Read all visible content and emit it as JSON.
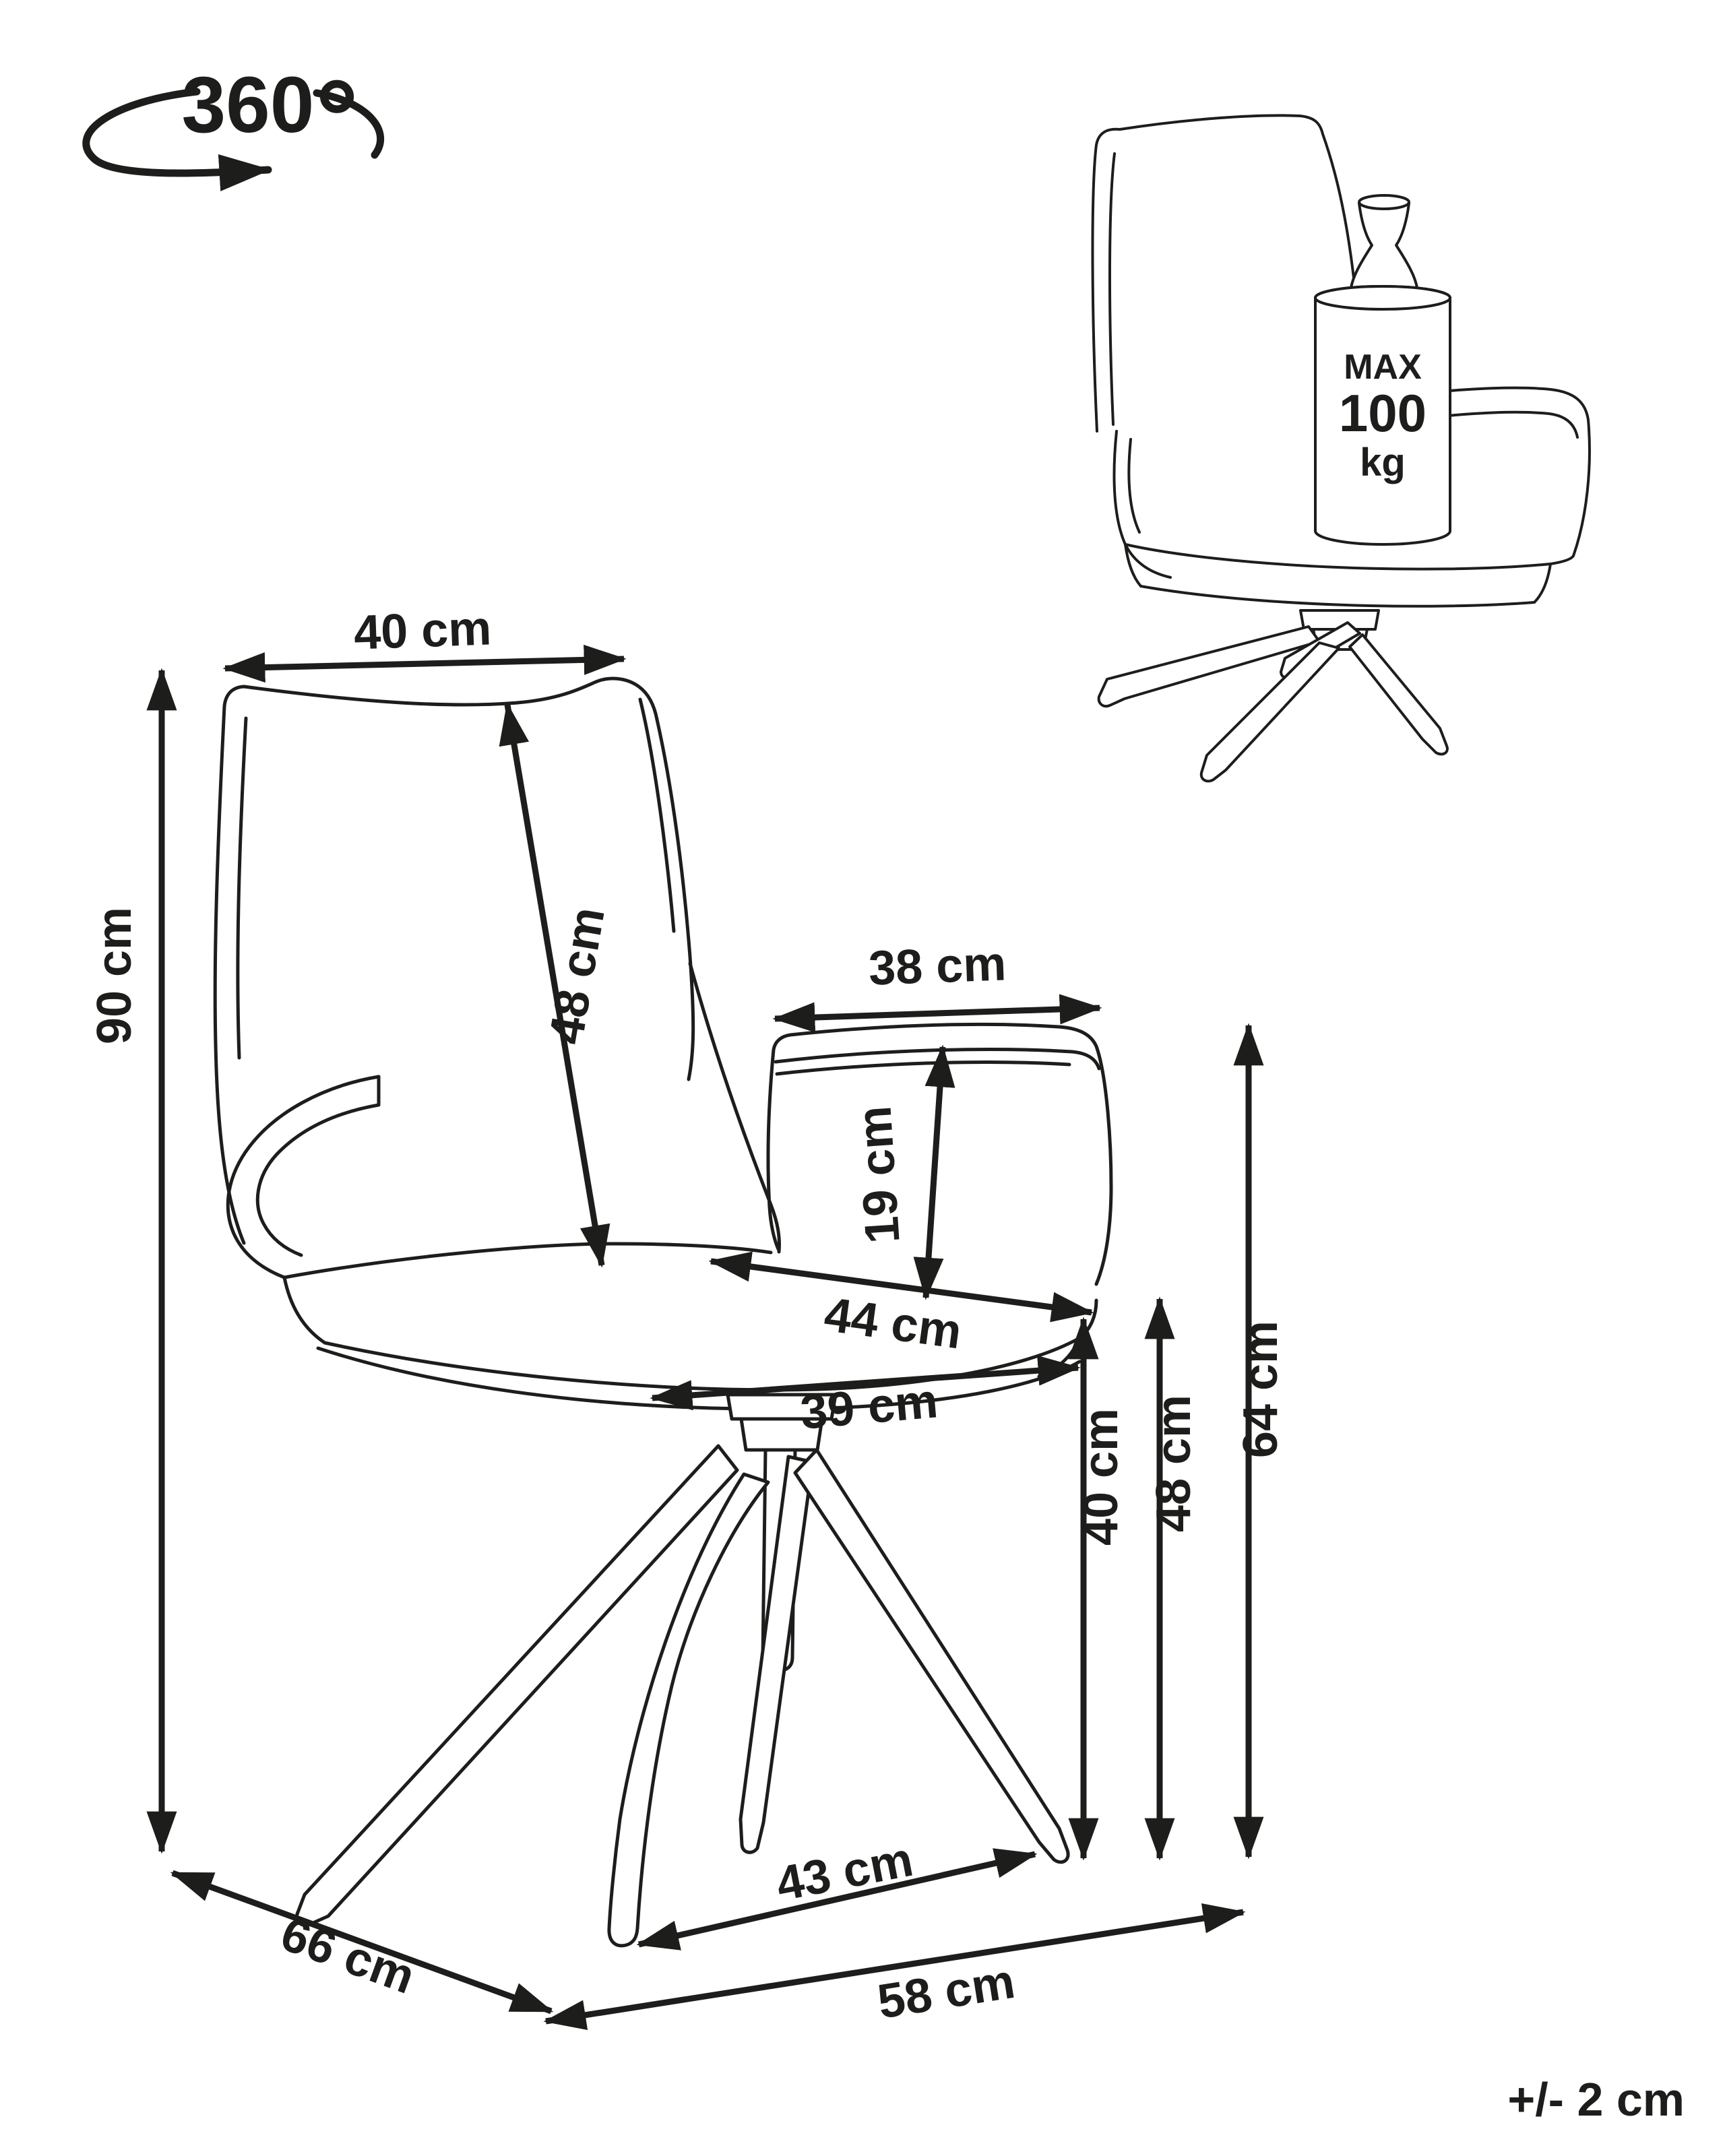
{
  "colors": {
    "ink": "#1d1d1b",
    "background": "#ffffff"
  },
  "rotation_icon": {
    "value": "360",
    "degree": "°"
  },
  "weight_limit": {
    "line1": "MAX",
    "line2": "100",
    "line3": "kg"
  },
  "tolerance": "+/- 2 cm",
  "dims": {
    "backrest_width": "40 cm",
    "backrest_height": "48 cm",
    "total_height": "90 cm",
    "armrest_length": "38 cm",
    "armrest_height_above_seat": "19 cm",
    "seat_depth": "44 cm",
    "seat_front_width": "39 cm",
    "seat_height_front": "40 cm",
    "seat_height_rear": "48 cm",
    "armrest_height_from_floor": "64 cm",
    "base_depth": "66 cm",
    "feet_spacing": "43 cm",
    "base_width": "58 cm"
  }
}
